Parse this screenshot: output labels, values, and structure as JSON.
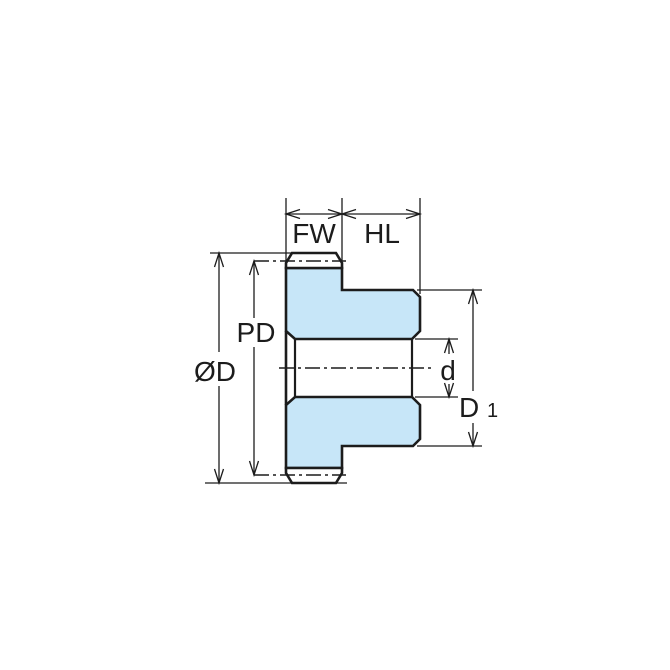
{
  "drawing": {
    "subject": "spur-gear-side-profile-dimension-drawing",
    "dimension_labels": {
      "face_width": "FW",
      "hub_length": "HL",
      "pitch_diameter": "PD",
      "outside_diameter": "ØD",
      "bore_diameter": "d",
      "hub_diameter": "D",
      "hub_diameter_subscript": "1"
    },
    "colors": {
      "background": "#ffffff",
      "gear_fill": "#c7e6f8",
      "tooth_face_fill": "#ffffff",
      "line": "#1c1c1c"
    }
  }
}
